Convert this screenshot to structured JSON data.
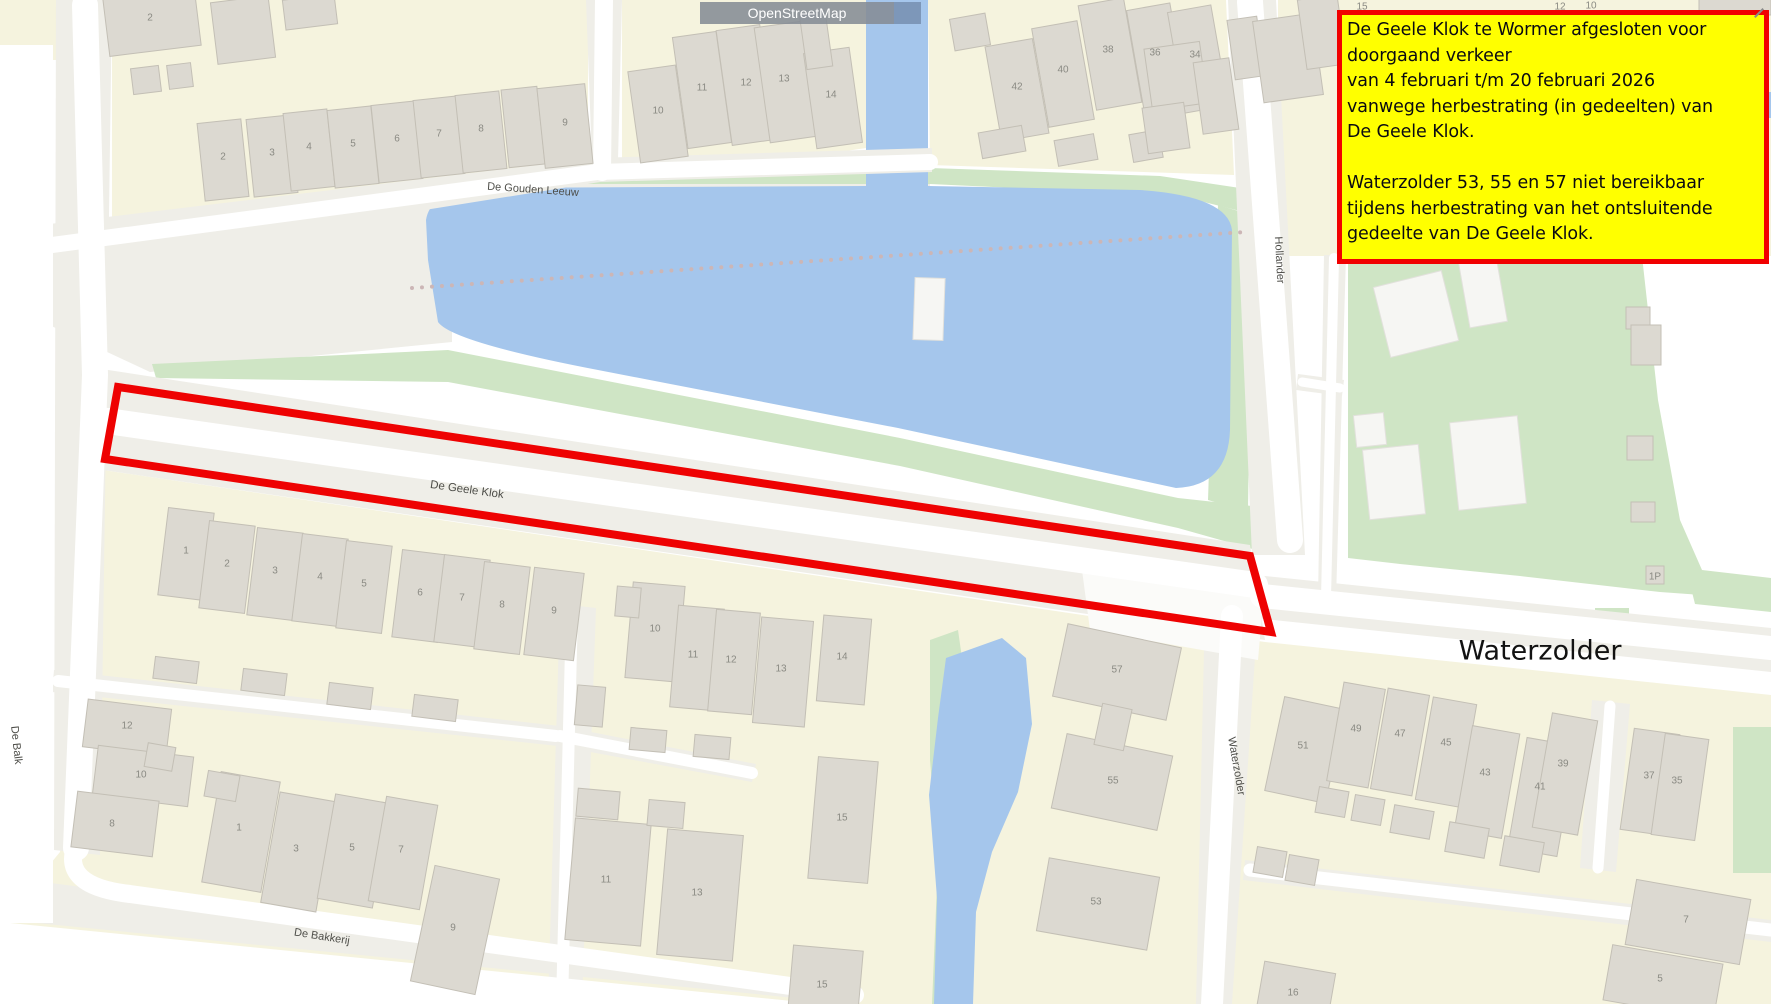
{
  "map": {
    "attribution": {
      "label": "OpenStreetMap"
    },
    "annotation_box": {
      "lines": [
        "De Geele Klok te Wormer afgesloten voor",
        "doorgaand verkeer",
        "van 4 februari t/m 20 februari 2026",
        "vanwege herbestrating (in gedeelten) van",
        "De Geele Klok.",
        "",
        "Waterzolder 53, 55 en 57 niet bereikbaar",
        "tijdens herbestrating van het ontsluitende",
        "gedeelte van De Geele Klok."
      ],
      "bg": "#ffff00",
      "border": "#f10000"
    },
    "closure_polygon": {
      "points": "118,387 1250,556 1271,632 105,459",
      "color": "#ee0202",
      "stroke_width": 8
    },
    "dotted_path": {
      "x1": 412,
      "y1": 288,
      "x2": 1245,
      "y2": 232,
      "color": "#ccb6b6"
    },
    "colors": {
      "water": "#a5c6ec",
      "green": "#cfe5c5",
      "residential": "#f5f3de",
      "building": "#dcd9d1",
      "road_corridor": "#efeee8",
      "road": "#ffffff",
      "closure_red": "#ee0202",
      "note_bg": "#ffff00",
      "note_border": "#f10000"
    },
    "street_labels": [
      {
        "text": "De Gouden Leeuw",
        "x": 533,
        "y": 189,
        "r": 4,
        "s": 11
      },
      {
        "text": "De Geele Klok",
        "x": 467,
        "y": 489,
        "r": 8,
        "s": 11.5
      },
      {
        "text": "De Balk",
        "x": 17,
        "y": 745,
        "r": 84,
        "s": 11
      },
      {
        "text": "De Bakkerij",
        "x": 322,
        "y": 936,
        "r": 9,
        "s": 11
      },
      {
        "text": "Hollander",
        "x": 1280,
        "y": 260,
        "r": 87,
        "s": 11
      },
      {
        "text": "Waterzolder",
        "x": 1237,
        "y": 766,
        "r": 80,
        "s": 11
      },
      {
        "text": "Waterzolder",
        "x": 1540,
        "y": 650,
        "r": 0,
        "s": 27,
        "k": "big"
      }
    ],
    "house_numbers": [
      {
        "n": "2",
        "x": 150,
        "y": 17
      },
      {
        "n": "2",
        "x": 223,
        "y": 156
      },
      {
        "n": "3",
        "x": 272,
        "y": 152
      },
      {
        "n": "4",
        "x": 309,
        "y": 146
      },
      {
        "n": "5",
        "x": 353,
        "y": 143
      },
      {
        "n": "6",
        "x": 397,
        "y": 138
      },
      {
        "n": "7",
        "x": 439,
        "y": 133
      },
      {
        "n": "8",
        "x": 481,
        "y": 128
      },
      {
        "n": "9",
        "x": 565,
        "y": 122
      },
      {
        "n": "10",
        "x": 658,
        "y": 110
      },
      {
        "n": "11",
        "x": 702,
        "y": 87
      },
      {
        "n": "12",
        "x": 746,
        "y": 82
      },
      {
        "n": "13",
        "x": 784,
        "y": 78
      },
      {
        "n": "14",
        "x": 831,
        "y": 94
      },
      {
        "n": "42",
        "x": 1017,
        "y": 86
      },
      {
        "n": "40",
        "x": 1063,
        "y": 69
      },
      {
        "n": "38",
        "x": 1108,
        "y": 49
      },
      {
        "n": "36",
        "x": 1155,
        "y": 52
      },
      {
        "n": "34",
        "x": 1195,
        "y": 54
      },
      {
        "n": "15",
        "x": 1362,
        "y": 6
      },
      {
        "n": "12",
        "x": 1560,
        "y": 6
      },
      {
        "n": "10",
        "x": 1591,
        "y": 5
      },
      {
        "n": "1",
        "x": 186,
        "y": 550
      },
      {
        "n": "2",
        "x": 227,
        "y": 563
      },
      {
        "n": "3",
        "x": 275,
        "y": 570
      },
      {
        "n": "4",
        "x": 320,
        "y": 576
      },
      {
        "n": "5",
        "x": 364,
        "y": 583
      },
      {
        "n": "6",
        "x": 420,
        "y": 592
      },
      {
        "n": "7",
        "x": 462,
        "y": 597
      },
      {
        "n": "8",
        "x": 502,
        "y": 604
      },
      {
        "n": "9",
        "x": 554,
        "y": 610
      },
      {
        "n": "12",
        "x": 127,
        "y": 725
      },
      {
        "n": "10",
        "x": 141,
        "y": 774
      },
      {
        "n": "8",
        "x": 112,
        "y": 823
      },
      {
        "n": "1",
        "x": 239,
        "y": 827
      },
      {
        "n": "3",
        "x": 296,
        "y": 848
      },
      {
        "n": "5",
        "x": 352,
        "y": 847
      },
      {
        "n": "7",
        "x": 401,
        "y": 849
      },
      {
        "n": "9",
        "x": 453,
        "y": 927
      },
      {
        "n": "10",
        "x": 655,
        "y": 628
      },
      {
        "n": "11",
        "x": 693,
        "y": 654
      },
      {
        "n": "12",
        "x": 731,
        "y": 659
      },
      {
        "n": "13",
        "x": 781,
        "y": 668
      },
      {
        "n": "14",
        "x": 842,
        "y": 656
      },
      {
        "n": "11",
        "x": 606,
        "y": 879
      },
      {
        "n": "13",
        "x": 697,
        "y": 892
      },
      {
        "n": "15",
        "x": 842,
        "y": 817
      },
      {
        "n": "15",
        "x": 822,
        "y": 984
      },
      {
        "n": "57",
        "x": 1117,
        "y": 669
      },
      {
        "n": "55",
        "x": 1113,
        "y": 780
      },
      {
        "n": "53",
        "x": 1096,
        "y": 901
      },
      {
        "n": "51",
        "x": 1303,
        "y": 745
      },
      {
        "n": "16",
        "x": 1293,
        "y": 992
      },
      {
        "n": "49",
        "x": 1356,
        "y": 728
      },
      {
        "n": "47",
        "x": 1400,
        "y": 733
      },
      {
        "n": "45",
        "x": 1446,
        "y": 742
      },
      {
        "n": "43",
        "x": 1485,
        "y": 772
      },
      {
        "n": "41",
        "x": 1540,
        "y": 786
      },
      {
        "n": "39",
        "x": 1563,
        "y": 763
      },
      {
        "n": "37",
        "x": 1649,
        "y": 775
      },
      {
        "n": "35",
        "x": 1677,
        "y": 780
      },
      {
        "n": "7",
        "x": 1686,
        "y": 919
      },
      {
        "n": "5",
        "x": 1660,
        "y": 978
      },
      {
        "n": "1P",
        "x": 1655,
        "y": 576
      }
    ],
    "buildings": [
      {
        "x": 152,
        "y": 22,
        "w": 92,
        "h": 58,
        "r": -7
      },
      {
        "x": 243,
        "y": 30,
        "w": 58,
        "h": 62,
        "r": -7
      },
      {
        "x": 310,
        "y": 12,
        "w": 52,
        "h": 30,
        "r": -7
      },
      {
        "x": 146,
        "y": 80,
        "w": 28,
        "h": 26,
        "r": -7
      },
      {
        "x": 180,
        "y": 76,
        "w": 24,
        "h": 24,
        "r": -7
      },
      {
        "x": 223,
        "y": 160,
        "w": 44,
        "h": 78,
        "r": -6
      },
      {
        "x": 272,
        "y": 156,
        "w": 44,
        "h": 78,
        "r": -6
      },
      {
        "x": 309,
        "y": 150,
        "w": 44,
        "h": 78,
        "r": -6
      },
      {
        "x": 353,
        "y": 147,
        "w": 44,
        "h": 78,
        "r": -6
      },
      {
        "x": 397,
        "y": 142,
        "w": 44,
        "h": 78,
        "r": -6
      },
      {
        "x": 439,
        "y": 137,
        "w": 44,
        "h": 78,
        "r": -6
      },
      {
        "x": 481,
        "y": 132,
        "w": 44,
        "h": 78,
        "r": -6
      },
      {
        "x": 523,
        "y": 127,
        "w": 36,
        "h": 78,
        "r": -6
      },
      {
        "x": 565,
        "y": 126,
        "w": 48,
        "h": 80,
        "r": -6
      },
      {
        "x": 658,
        "y": 114,
        "w": 48,
        "h": 92,
        "r": -8
      },
      {
        "x": 702,
        "y": 90,
        "w": 44,
        "h": 112,
        "r": -8
      },
      {
        "x": 746,
        "y": 85,
        "w": 44,
        "h": 116,
        "r": -8
      },
      {
        "x": 786,
        "y": 82,
        "w": 48,
        "h": 116,
        "r": -8
      },
      {
        "x": 833,
        "y": 98,
        "w": 46,
        "h": 96,
        "r": -8
      },
      {
        "x": 816,
        "y": 40,
        "w": 26,
        "h": 56,
        "r": -8
      },
      {
        "x": 1017,
        "y": 90,
        "w": 48,
        "h": 96,
        "r": -10
      },
      {
        "x": 1063,
        "y": 74,
        "w": 46,
        "h": 100,
        "r": -10
      },
      {
        "x": 1110,
        "y": 54,
        "w": 46,
        "h": 106,
        "r": -10
      },
      {
        "x": 1157,
        "y": 57,
        "w": 44,
        "h": 102,
        "r": -10
      },
      {
        "x": 1198,
        "y": 59,
        "w": 44,
        "h": 102,
        "r": -10
      },
      {
        "x": 970,
        "y": 32,
        "w": 36,
        "h": 32,
        "r": -10
      },
      {
        "x": 1002,
        "y": 142,
        "w": 44,
        "h": 26,
        "r": -10
      },
      {
        "x": 1076,
        "y": 150,
        "w": 40,
        "h": 26,
        "r": -10
      },
      {
        "x": 1146,
        "y": 146,
        "w": 30,
        "h": 28,
        "r": -10
      },
      {
        "x": 1176,
        "y": 76,
        "w": 56,
        "h": 62,
        "r": -8
      },
      {
        "x": 1166,
        "y": 128,
        "w": 42,
        "h": 46,
        "r": -8
      },
      {
        "x": 1216,
        "y": 96,
        "w": 36,
        "h": 72,
        "r": -8
      },
      {
        "x": 1246,
        "y": 48,
        "w": 30,
        "h": 60,
        "r": -8
      },
      {
        "x": 1288,
        "y": 58,
        "w": 60,
        "h": 82,
        "r": -8
      },
      {
        "x": 1322,
        "y": 32,
        "w": 40,
        "h": 70,
        "r": -8
      },
      {
        "x": 1735,
        "y": 7,
        "w": 72,
        "h": 16,
        "r": 0
      },
      {
        "x": 186,
        "y": 554,
        "w": 46,
        "h": 88,
        "r": 7
      },
      {
        "x": 227,
        "y": 567,
        "w": 46,
        "h": 88,
        "r": 7
      },
      {
        "x": 275,
        "y": 574,
        "w": 46,
        "h": 88,
        "r": 7
      },
      {
        "x": 320,
        "y": 580,
        "w": 46,
        "h": 88,
        "r": 7
      },
      {
        "x": 364,
        "y": 587,
        "w": 46,
        "h": 88,
        "r": 7
      },
      {
        "x": 420,
        "y": 596,
        "w": 46,
        "h": 88,
        "r": 7
      },
      {
        "x": 462,
        "y": 601,
        "w": 46,
        "h": 88,
        "r": 7
      },
      {
        "x": 502,
        "y": 608,
        "w": 46,
        "h": 88,
        "r": 7
      },
      {
        "x": 554,
        "y": 614,
        "w": 50,
        "h": 88,
        "r": 7
      },
      {
        "x": 176,
        "y": 670,
        "w": 44,
        "h": 22,
        "r": 7
      },
      {
        "x": 264,
        "y": 682,
        "w": 44,
        "h": 22,
        "r": 7
      },
      {
        "x": 350,
        "y": 696,
        "w": 44,
        "h": 22,
        "r": 7
      },
      {
        "x": 435,
        "y": 708,
        "w": 44,
        "h": 22,
        "r": 7
      },
      {
        "x": 127,
        "y": 728,
        "w": 84,
        "h": 48,
        "r": 7
      },
      {
        "x": 143,
        "y": 776,
        "w": 96,
        "h": 50,
        "r": 7
      },
      {
        "x": 115,
        "y": 824,
        "w": 82,
        "h": 56,
        "r": 7
      },
      {
        "x": 241,
        "y": 832,
        "w": 60,
        "h": 112,
        "r": 10
      },
      {
        "x": 298,
        "y": 852,
        "w": 56,
        "h": 112,
        "r": 10
      },
      {
        "x": 354,
        "y": 851,
        "w": 56,
        "h": 106,
        "r": 10
      },
      {
        "x": 403,
        "y": 853,
        "w": 52,
        "h": 106,
        "r": 10
      },
      {
        "x": 455,
        "y": 930,
        "w": 66,
        "h": 118,
        "r": 12
      },
      {
        "x": 222,
        "y": 786,
        "w": 32,
        "h": 26,
        "r": 10
      },
      {
        "x": 160,
        "y": 757,
        "w": 28,
        "h": 24,
        "r": 10
      },
      {
        "x": 655,
        "y": 632,
        "w": 52,
        "h": 96,
        "r": 5
      },
      {
        "x": 697,
        "y": 658,
        "w": 46,
        "h": 102,
        "r": 5
      },
      {
        "x": 734,
        "y": 662,
        "w": 44,
        "h": 102,
        "r": 5
      },
      {
        "x": 783,
        "y": 672,
        "w": 52,
        "h": 106,
        "r": 5
      },
      {
        "x": 844,
        "y": 660,
        "w": 48,
        "h": 86,
        "r": 5
      },
      {
        "x": 628,
        "y": 602,
        "w": 24,
        "h": 30,
        "r": 5
      },
      {
        "x": 648,
        "y": 740,
        "w": 36,
        "h": 22,
        "r": 5
      },
      {
        "x": 712,
        "y": 747,
        "w": 36,
        "h": 22,
        "r": 5
      },
      {
        "x": 590,
        "y": 706,
        "w": 28,
        "h": 40,
        "r": 5
      },
      {
        "x": 608,
        "y": 882,
        "w": 76,
        "h": 122,
        "r": 5
      },
      {
        "x": 700,
        "y": 895,
        "w": 76,
        "h": 126,
        "r": 5
      },
      {
        "x": 843,
        "y": 820,
        "w": 60,
        "h": 122,
        "r": 5
      },
      {
        "x": 825,
        "y": 987,
        "w": 70,
        "h": 78,
        "r": 5
      },
      {
        "x": 598,
        "y": 804,
        "w": 42,
        "h": 28,
        "r": 5
      },
      {
        "x": 666,
        "y": 814,
        "w": 36,
        "h": 26,
        "r": 5
      },
      {
        "x": 1117,
        "y": 672,
        "w": 116,
        "h": 74,
        "r": 12
      },
      {
        "x": 1112,
        "y": 782,
        "w": 108,
        "h": 76,
        "r": 12
      },
      {
        "x": 1098,
        "y": 904,
        "w": 112,
        "h": 74,
        "r": 10
      },
      {
        "x": 1113,
        "y": 727,
        "w": 30,
        "h": 42,
        "r": 12
      },
      {
        "x": 1305,
        "y": 750,
        "w": 62,
        "h": 96,
        "r": 12
      },
      {
        "x": 1295,
        "y": 997,
        "w": 72,
        "h": 60,
        "r": 10
      },
      {
        "x": 1270,
        "y": 862,
        "w": 30,
        "h": 26,
        "r": 10
      },
      {
        "x": 1302,
        "y": 870,
        "w": 30,
        "h": 26,
        "r": 10
      },
      {
        "x": 1356,
        "y": 735,
        "w": 42,
        "h": 100,
        "r": 10
      },
      {
        "x": 1400,
        "y": 742,
        "w": 42,
        "h": 102,
        "r": 10
      },
      {
        "x": 1446,
        "y": 752,
        "w": 44,
        "h": 104,
        "r": 10
      },
      {
        "x": 1487,
        "y": 782,
        "w": 48,
        "h": 106,
        "r": 10
      },
      {
        "x": 1542,
        "y": 797,
        "w": 50,
        "h": 112,
        "r": 10
      },
      {
        "x": 1565,
        "y": 774,
        "w": 46,
        "h": 116,
        "r": 10
      },
      {
        "x": 1650,
        "y": 782,
        "w": 46,
        "h": 102,
        "r": 8
      },
      {
        "x": 1680,
        "y": 787,
        "w": 44,
        "h": 102,
        "r": 8
      },
      {
        "x": 1332,
        "y": 802,
        "w": 30,
        "h": 26,
        "r": 10
      },
      {
        "x": 1368,
        "y": 810,
        "w": 30,
        "h": 26,
        "r": 10
      },
      {
        "x": 1412,
        "y": 822,
        "w": 40,
        "h": 28,
        "r": 10
      },
      {
        "x": 1467,
        "y": 840,
        "w": 40,
        "h": 30,
        "r": 10
      },
      {
        "x": 1522,
        "y": 854,
        "w": 40,
        "h": 30,
        "r": 10
      },
      {
        "x": 1688,
        "y": 922,
        "w": 116,
        "h": 66,
        "r": 10
      },
      {
        "x": 1663,
        "y": 982,
        "w": 112,
        "h": 56,
        "r": 10
      },
      {
        "x": 1655,
        "y": 575,
        "w": 18,
        "h": 18,
        "r": 0
      },
      {
        "x": 1638,
        "y": 318,
        "w": 24,
        "h": 22,
        "r": 0
      },
      {
        "x": 1646,
        "y": 345,
        "w": 30,
        "h": 40,
        "r": 0
      },
      {
        "x": 1640,
        "y": 448,
        "w": 26,
        "h": 24,
        "r": 0
      },
      {
        "x": 1643,
        "y": 512,
        "w": 24,
        "h": 20,
        "r": 0
      },
      {
        "x": 1416,
        "y": 314,
        "w": 70,
        "h": 72,
        "r": -14,
        "t": "w"
      },
      {
        "x": 1483,
        "y": 292,
        "w": 38,
        "h": 66,
        "r": -10,
        "t": "w"
      },
      {
        "x": 1488,
        "y": 463,
        "w": 68,
        "h": 88,
        "r": -6,
        "t": "w"
      },
      {
        "x": 1394,
        "y": 482,
        "w": 56,
        "h": 70,
        "r": -6,
        "t": "w"
      },
      {
        "x": 1370,
        "y": 430,
        "w": 30,
        "h": 32,
        "r": -6,
        "t": "w"
      },
      {
        "x": 929,
        "y": 309,
        "w": 30,
        "h": 62,
        "r": 2,
        "t": "w"
      }
    ]
  }
}
